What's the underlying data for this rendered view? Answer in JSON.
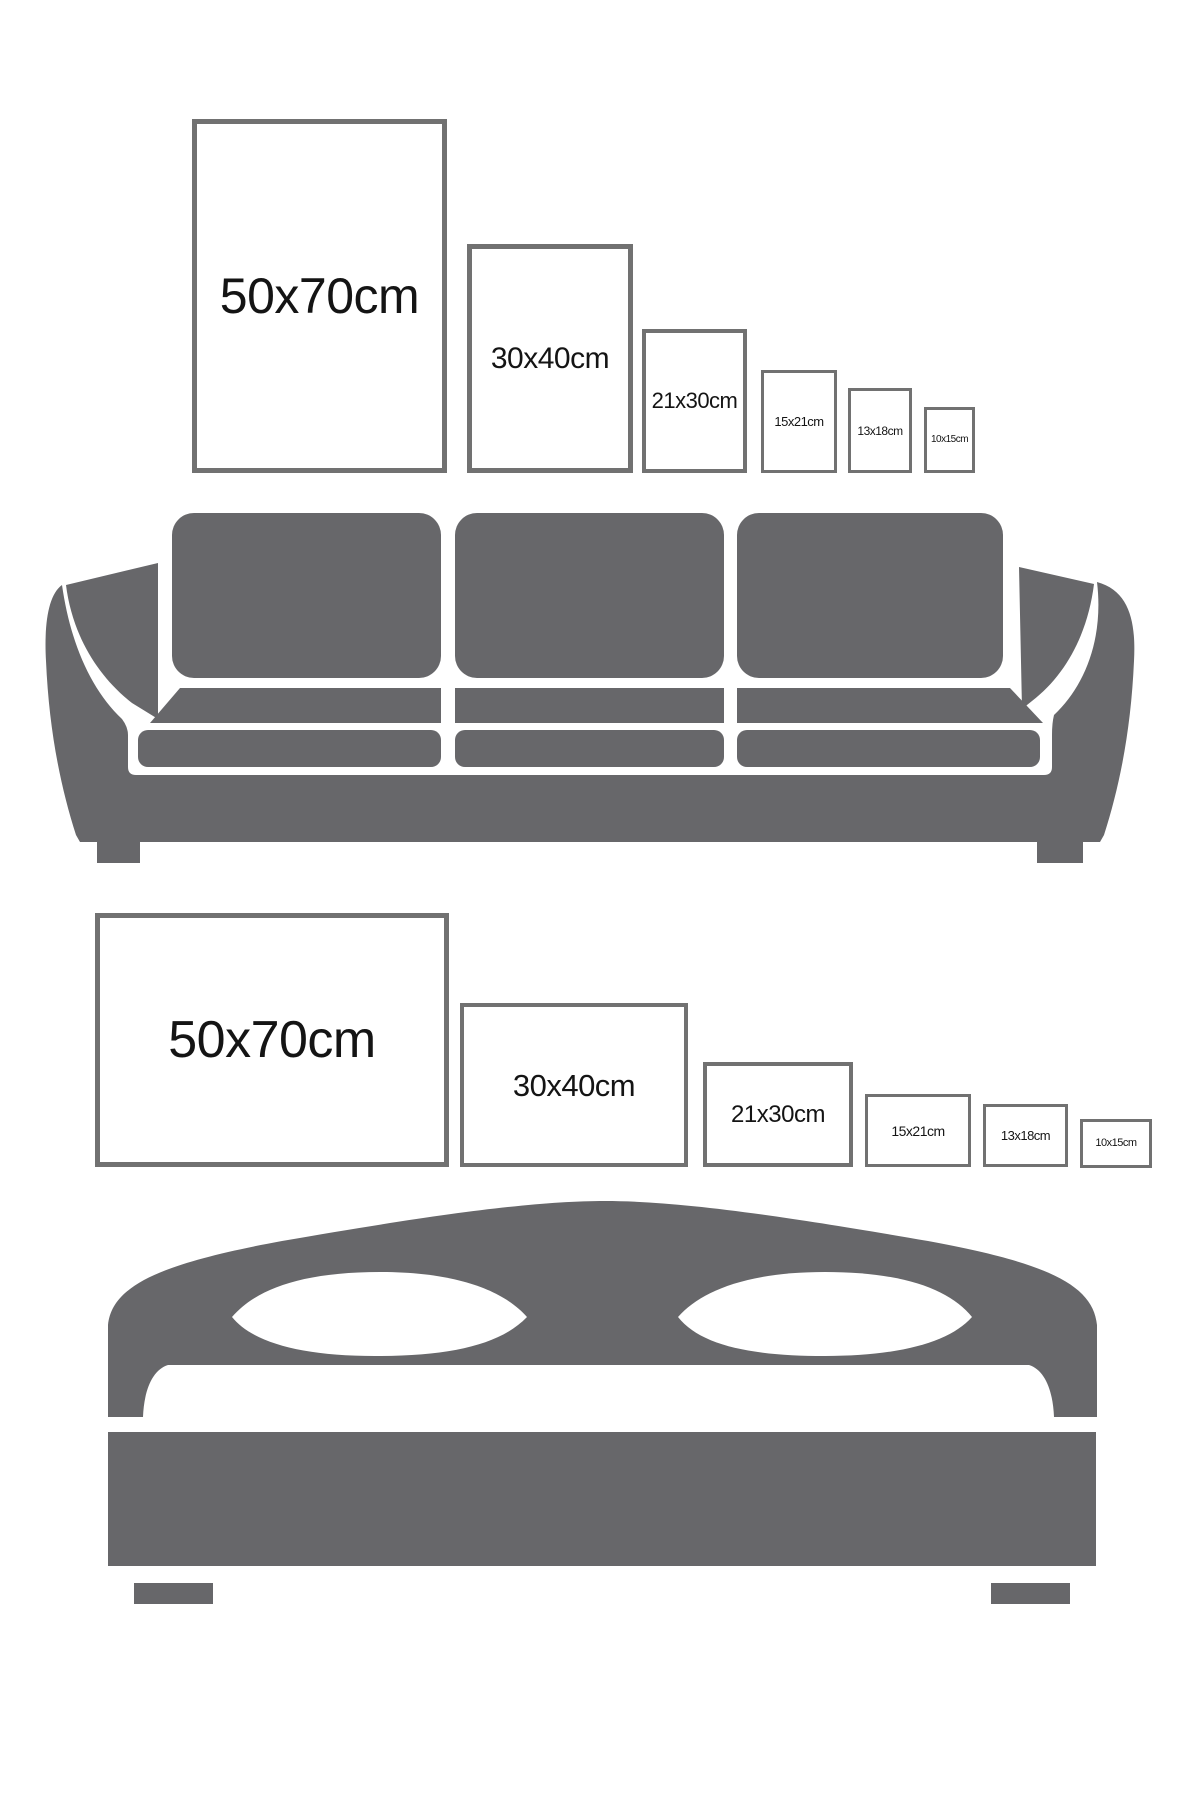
{
  "colors": {
    "furniture_gray": "#67676a",
    "frame_border": "#717171",
    "label_text": "#141414",
    "background": "#ffffff"
  },
  "sofa_section": {
    "furniture_icon": "sofa",
    "frames": [
      {
        "label": "50x70cm",
        "orientation": "portrait"
      },
      {
        "label": "30x40cm",
        "orientation": "portrait"
      },
      {
        "label": "21x30cm",
        "orientation": "portrait"
      },
      {
        "label": "15x21cm",
        "orientation": "portrait"
      },
      {
        "label": "13x18cm",
        "orientation": "portrait"
      },
      {
        "label": "10x15cm",
        "orientation": "portrait"
      }
    ]
  },
  "bed_section": {
    "furniture_icon": "bed",
    "frames": [
      {
        "label": "50x70cm",
        "orientation": "landscape"
      },
      {
        "label": "30x40cm",
        "orientation": "landscape"
      },
      {
        "label": "21x30cm",
        "orientation": "landscape"
      },
      {
        "label": "15x21cm",
        "orientation": "landscape"
      },
      {
        "label": "13x18cm",
        "orientation": "landscape"
      },
      {
        "label": "10x15cm",
        "orientation": "landscape"
      }
    ]
  }
}
